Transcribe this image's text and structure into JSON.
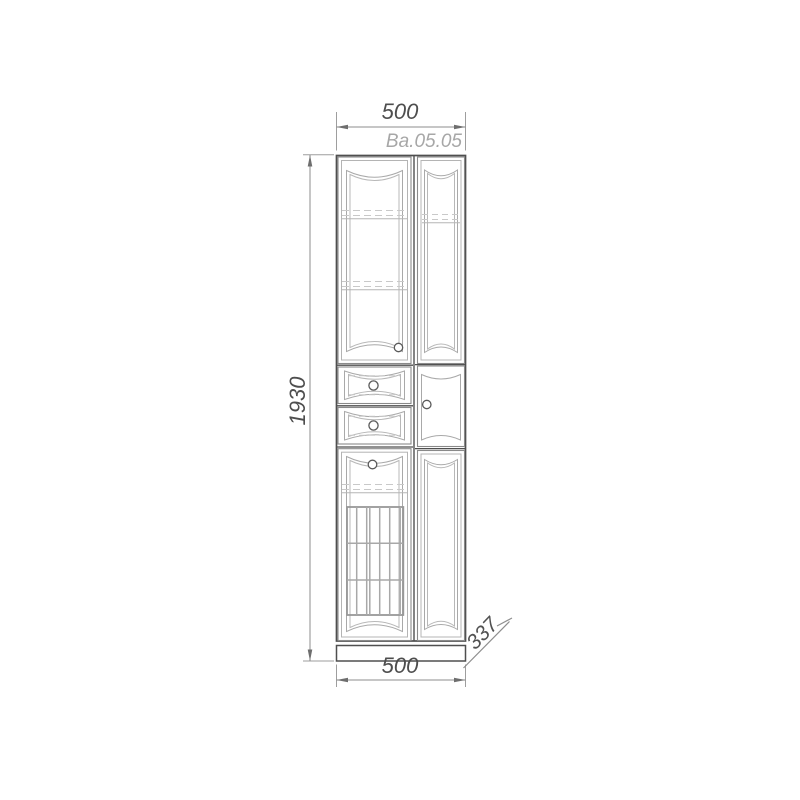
{
  "drawing": {
    "kind": "furniture front-elevation technical drawing",
    "object": "tall two-column cabinet with glass doors, two drawers and laundry basket"
  },
  "labels": {
    "top_width": "500",
    "model_code": "Ba.05.05",
    "height": "1930",
    "bottom_width": "500",
    "depth": "337"
  },
  "colors": {
    "background": "#ffffff",
    "frame_line": "#4f4f4f",
    "door_line": "#8a8a8a",
    "panel_line": "#a9a9a9",
    "dashed_line": "#c9c9c9",
    "dimension_line": "#8e8e8e",
    "dimension_text": "#4e4e4e",
    "model_text": "#a7a7a7"
  }
}
